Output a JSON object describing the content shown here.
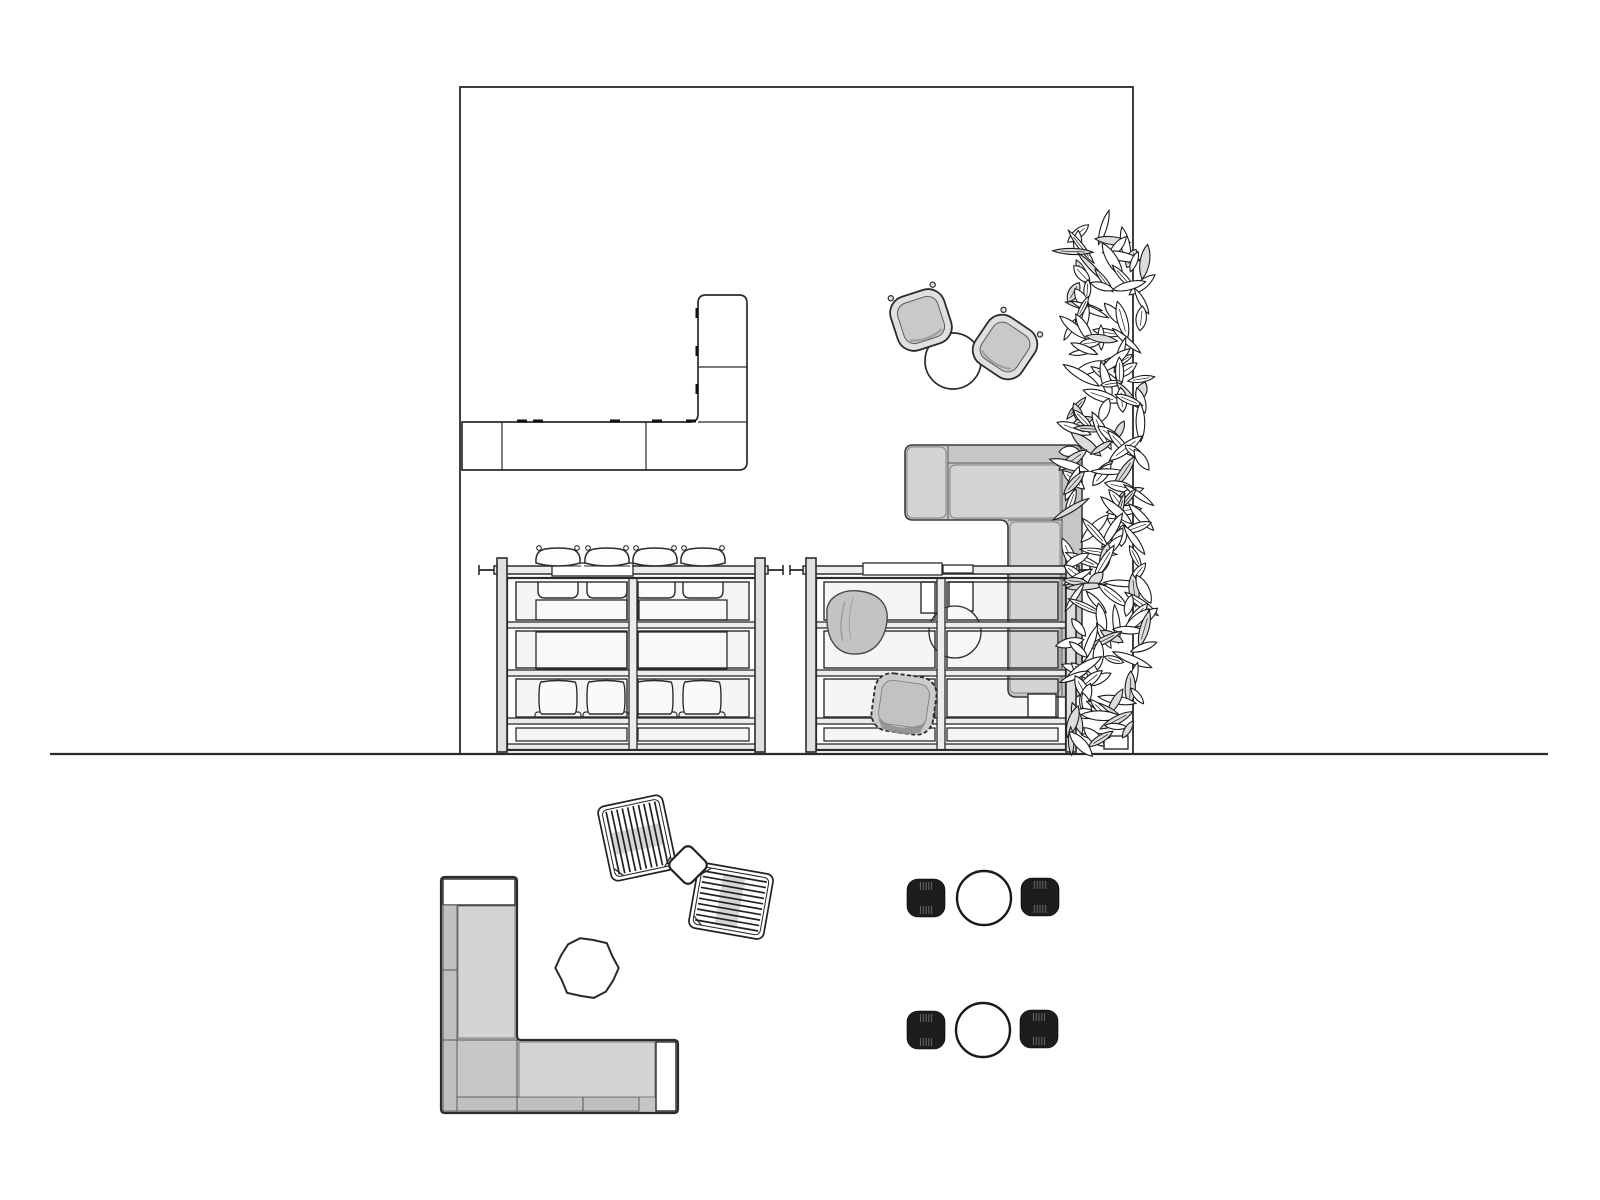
{
  "canvas": {
    "width": 1600,
    "height": 1200,
    "background": "#ffffff"
  },
  "palette": {
    "line": "#2b2b2b",
    "line_soft": "#5a5a5a",
    "line_faint": "#8a8a8a",
    "white": "#ffffff",
    "panel": "#f5f5f5",
    "inner_rect": "#f8f8f8",
    "rail_fill": "#ececec",
    "post_fill": "#e0e0e0",
    "sofa_base": "#c6c6c6",
    "sofa_seat": "#d4d4d4",
    "sofa_back": "#c0c0c0",
    "chair_shell": "#e0e0e0",
    "chair_seat": "#c9c9c9",
    "blob": "#c3c3c3",
    "woven": "#cbcbcb",
    "woven_inner": "#c2c2c2",
    "shadow": "#8d8d8d",
    "black_chair": "#1d1d1d",
    "stripe": "#7a7a7a",
    "leaf_shade": "#dcdcdc",
    "band": "#d6d6d6"
  },
  "ground_line": {
    "x1": 50,
    "x2": 1548,
    "y": 754
  },
  "room": {
    "x": 460,
    "y": 87,
    "w": 673,
    "h": 667
  },
  "counter": {
    "wall_x": 462,
    "bar_top": 422,
    "bar_bottom": 470,
    "bar_right": 747,
    "v_left": 698,
    "v_top": 295,
    "corner_r": 8,
    "seam_xs": [
      502,
      646
    ],
    "v_seam_y": 367,
    "top_dashes_x": [
      517,
      533,
      610,
      652,
      686
    ],
    "left_dashes_y": [
      308,
      346,
      384
    ],
    "dash_len": 10
  },
  "cafe_set": {
    "table": {
      "cx": 953,
      "cy": 361,
      "r": 28
    },
    "chair_size": 56,
    "chairs": [
      {
        "cx": 921,
        "cy": 320,
        "rot": -18
      },
      {
        "cx": 1005,
        "cy": 347,
        "rot": 34
      }
    ]
  },
  "sofa_room": {
    "left": 905,
    "top": 445,
    "right": 1082,
    "bottom": 697,
    "arm_bottom": 520,
    "v_left": 1008,
    "r": 8,
    "seam_x": 948,
    "back_y": 463,
    "back_x": 1062,
    "ottoman": {
      "x": 1028,
      "y": 694,
      "w": 28,
      "h": 24
    }
  },
  "frame_tables": [
    {
      "id": "left",
      "frame": {
        "x": 507,
        "y": 578,
        "w": 250,
        "h": 172
      },
      "posts_x": [
        497,
        755
      ],
      "post_w": 10,
      "post_y1": 558,
      "post_y2": 752,
      "rail": {
        "x1": 479,
        "x2": 783,
        "y": 566,
        "h": 8
      },
      "divider": {
        "x": 629,
        "w": 8
      },
      "panels_x": [
        [
          516,
          627
        ],
        [
          638,
          749
        ]
      ],
      "rows_y": [
        [
          582,
          620
        ],
        [
          631,
          668
        ],
        [
          679,
          717
        ]
      ],
      "rail_bands_y": [
        622,
        670,
        718,
        744
      ],
      "band_h": 6,
      "stools_x": [
        558,
        607,
        655,
        703
      ],
      "stool_y": 556,
      "seat_y": 582,
      "row1_rects": [
        [
          536,
          600,
          91,
          20
        ],
        [
          639,
          600,
          88,
          20
        ]
      ],
      "row2_rects": [
        [
          536,
          632,
          91,
          37
        ],
        [
          638,
          632,
          89,
          37
        ]
      ],
      "row3_chairs_x": [
        558,
        606,
        654,
        702
      ],
      "row3_chair_y": 700,
      "row4_rects": [
        [
          516,
          728,
          111,
          13
        ],
        [
          638,
          728,
          111,
          13
        ]
      ],
      "rail_items": [
        [
          552,
          563,
          81,
          13
        ]
      ]
    },
    {
      "id": "right",
      "frame": {
        "x": 816,
        "y": 578,
        "w": 250,
        "h": 172
      },
      "posts_x": [
        806,
        1066
      ],
      "post_w": 10,
      "post_y1": 558,
      "post_y2": 752,
      "rail": {
        "x1": 790,
        "x2": 1090,
        "y": 566,
        "h": 8
      },
      "divider": {
        "x": 937,
        "w": 8
      },
      "panels_x": [
        [
          824,
          935
        ],
        [
          947,
          1058
        ]
      ],
      "rows_y": [
        [
          582,
          620
        ],
        [
          631,
          668
        ],
        [
          679,
          717
        ]
      ],
      "rail_bands_y": [
        622,
        670,
        718,
        744
      ],
      "band_h": 6,
      "row4_rects": [
        [
          824,
          728,
          111,
          13
        ],
        [
          947,
          728,
          111,
          13
        ]
      ],
      "rail_items": [
        [
          863,
          563,
          79,
          12
        ],
        [
          943,
          565,
          30,
          8
        ]
      ],
      "partitions": [
        [
          921,
          582,
          16,
          31
        ],
        [
          949,
          582,
          24,
          29
        ]
      ],
      "under_table": {
        "cx": 955,
        "cy": 632,
        "r": 26
      },
      "bean_bag": {
        "cx": 857,
        "cy": 623
      },
      "woven_chair": {
        "cx": 904,
        "cy": 704,
        "rot": 8
      }
    }
  ],
  "green_wall": {
    "cx": 1107,
    "top": 230,
    "bottom": 746,
    "half_w": 40,
    "leaf_count": 175,
    "seed": 13,
    "pot": {
      "x": 1104,
      "y": 736,
      "w": 24,
      "h": 13
    }
  },
  "lounge": {
    "sofa": {
      "left": 441,
      "top": 877,
      "right": 678,
      "bottom": 1113,
      "v_right": 517,
      "arm_top": 1040,
      "cap_top_h": 26,
      "cap_right_w": 22,
      "back_w": 14,
      "back_split_y": 970,
      "seat_split_x": 583
    },
    "round_table": {
      "cx": 587,
      "cy": 968,
      "r": 30,
      "sides": 14
    },
    "slat_chairs": [
      {
        "cx": 637,
        "cy": 838,
        "rot": -12
      },
      {
        "cx": 731,
        "cy": 901,
        "rot": 100
      }
    ],
    "slat_count": 10,
    "side_table": {
      "cx": 688,
      "cy": 865,
      "size": 30,
      "rot": 45
    }
  },
  "dining": {
    "table_r": 27,
    "chair_size": 38,
    "sets": [
      {
        "table": {
          "cx": 984,
          "cy": 898
        },
        "chairs": [
          {
            "cx": 926,
            "cy": 898
          },
          {
            "cx": 1040,
            "cy": 897
          }
        ]
      },
      {
        "table": {
          "cx": 983,
          "cy": 1030
        },
        "chairs": [
          {
            "cx": 926,
            "cy": 1030
          },
          {
            "cx": 1039,
            "cy": 1029
          }
        ]
      }
    ]
  }
}
